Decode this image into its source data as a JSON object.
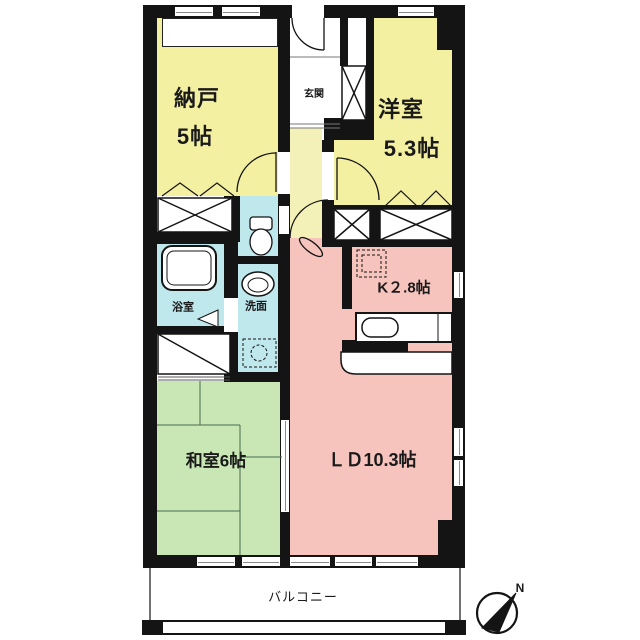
{
  "title": "マンション間取り図 (2LDK+S floor plan)",
  "rooms": {
    "nando": {
      "name": "納戸",
      "size": "5帖"
    },
    "yoshitsu": {
      "name": "洋室",
      "size": "5.3帖"
    },
    "genkan": {
      "name": "玄関"
    },
    "kitchen": {
      "name": "K２.8帖"
    },
    "bath": {
      "name": "浴室"
    },
    "senmen": {
      "name": "洗面"
    },
    "washitsu": {
      "name": "和室6帖"
    },
    "ld": {
      "name": "ＬＤ10.3帖"
    },
    "balcony": {
      "name": "バルコニー"
    }
  },
  "fixtures": {
    "bathtub": "bathtub",
    "toilet": "toilet",
    "wash_basin": "wash-basin",
    "kitchen_sink": "kitchen-sink-counter",
    "fridge_space": "refrigerator-space",
    "washer_space": "washing-machine-space",
    "entrance_door": "entrance-door",
    "closets": "closets-with-x"
  },
  "compass": {
    "north_label": "N"
  },
  "colors": {
    "room_yellow": "#F4F0A2",
    "room_pink": "#F6C3BD",
    "room_green": "#C8E7B4",
    "wet_cyan": "#BFE8EC",
    "hall_cream": "#F4F1B8",
    "wall": "#141414"
  }
}
